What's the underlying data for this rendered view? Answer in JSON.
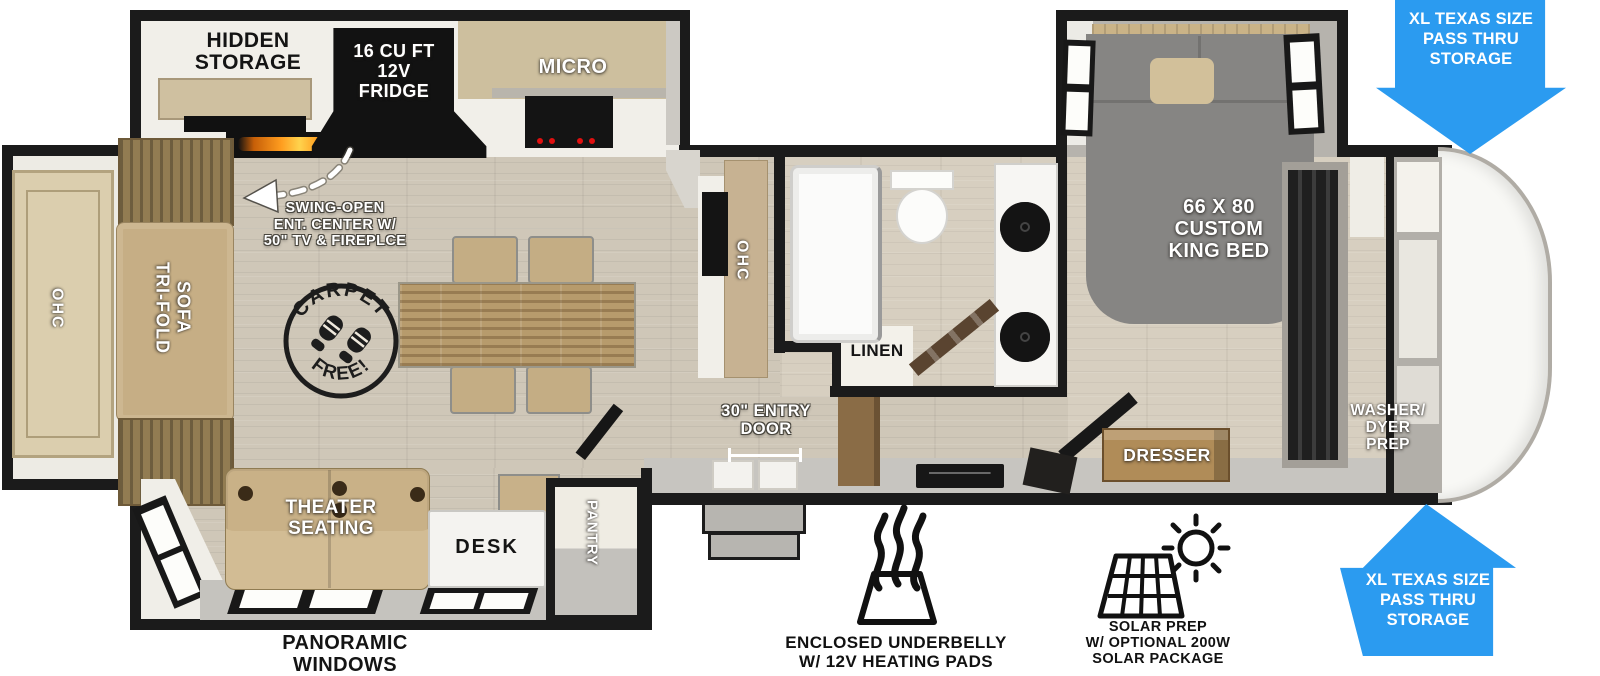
{
  "colors": {
    "wall": "#1b1b1b",
    "floor_tan": "#cfc7b8",
    "accent_blue": "#2b9bf0",
    "furniture_tan": "#c8b189",
    "appliance_black": "#141414",
    "flame_orange": "#ff9d1f"
  },
  "stamp": {
    "top": "CARPET",
    "bottom": "FREE!"
  },
  "labels": {
    "hidden_storage": "HIDDEN\nSTORAGE",
    "fridge": "16 CU FT\n12V\nFRIDGE",
    "micro": "MICRO",
    "swing_open": "SWING-OPEN\nENT. CENTER W/\n50\" TV & FIREPLCE",
    "ohc_left": "OHC",
    "tri_fold_sofa": "TRI-FOLD\nSOFA",
    "ohc_mid": "OHC",
    "linen": "LINEN",
    "entry_door": "30\" ENTRY\nDOOR",
    "king_bed": "66 X 80\nCUSTOM\nKING BED",
    "dresser": "DRESSER",
    "washer_dryer": "WASHER/\nDYER\nPREP",
    "theater": "THEATER\nSEATING",
    "desk": "DESK",
    "pantry": "PANTRY",
    "panoramic": "PANORAMIC\nWINDOWS",
    "underbelly": "ENCLOSED UNDERBELLY\nW/ 12V HEATING PADS",
    "solar": "SOLAR PREP\nW/ OPTIONAL 200W\nSOLAR PACKAGE",
    "pass_thru": "XL TEXAS SIZE\nPASS THRU\nSTORAGE"
  }
}
